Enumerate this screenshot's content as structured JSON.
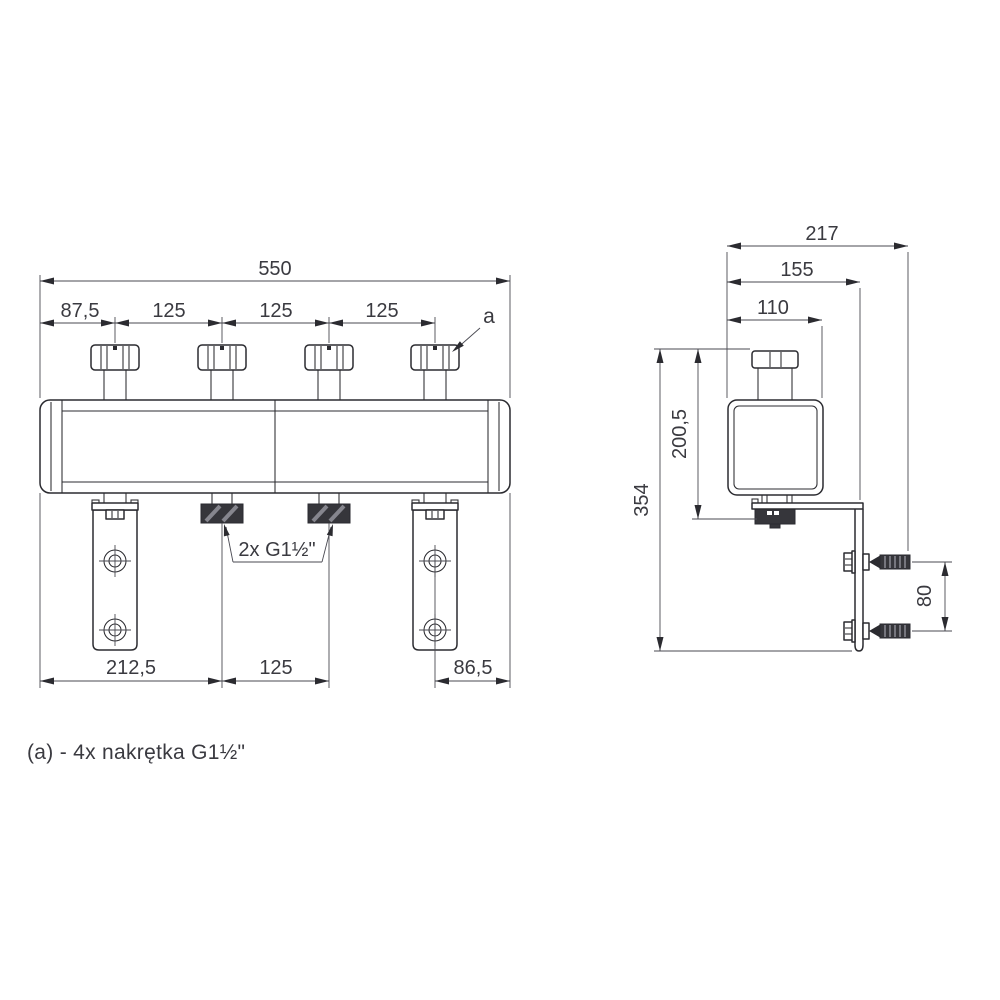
{
  "front": {
    "dim_total": "550",
    "dim_offsets": [
      "87,5",
      "125",
      "125",
      "125"
    ],
    "label_a": "a",
    "label_ports": "2x G1½\"",
    "dim_bottom_left": "212,5",
    "dim_bottom_mid": "125",
    "dim_bottom_right": "86,5"
  },
  "side": {
    "dim_depth_total": "217",
    "dim_depth_plate": "155",
    "dim_depth_body": "110",
    "dim_height_total": "354",
    "dim_height_body": "200,5",
    "dim_anchor_gap": "80"
  },
  "note": "(a) -  4x nakrętka G1½\"",
  "colors": {
    "line": "#2b2b30",
    "text": "#3a3a40",
    "thread_fill": "#36363b",
    "background": "#ffffff"
  }
}
